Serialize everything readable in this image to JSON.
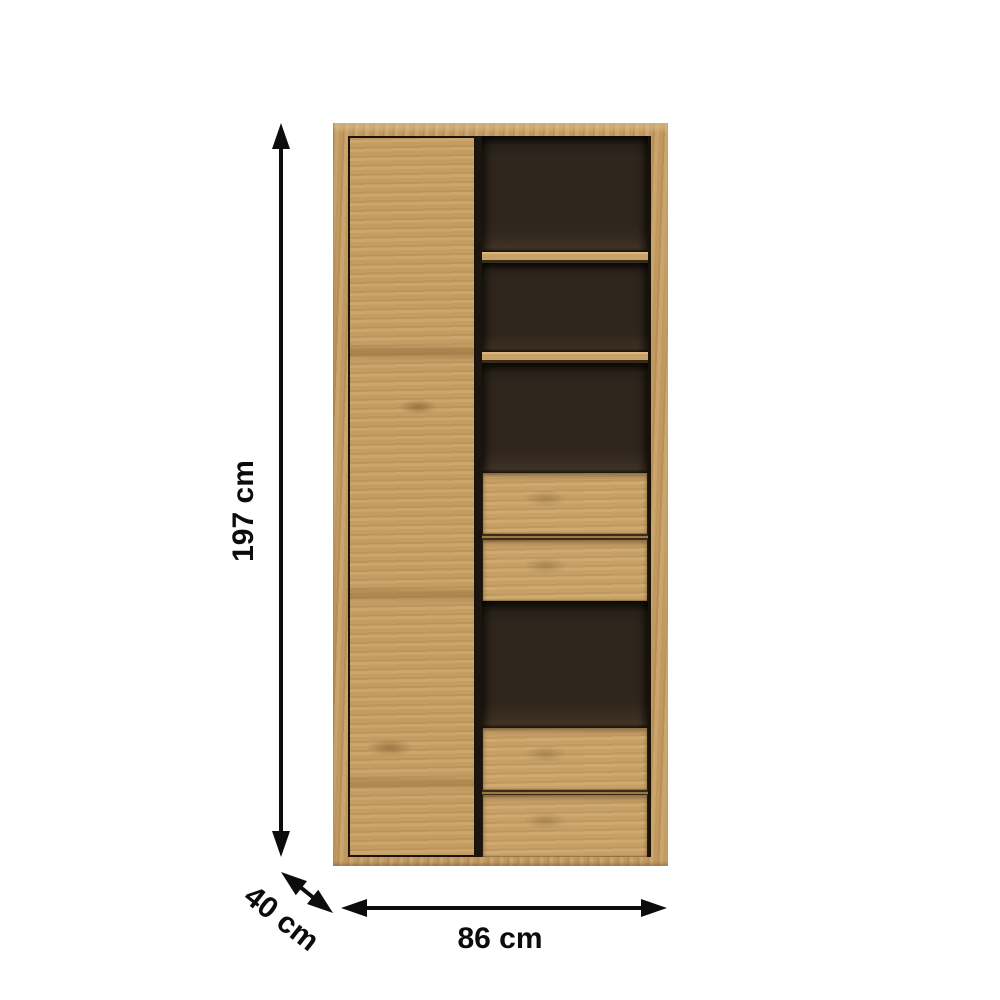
{
  "diagram": {
    "type": "furniture-dimension-diagram",
    "dimensions": {
      "height": "197 cm",
      "depth": "40 cm",
      "width": "86 cm"
    },
    "icons": {
      "height_arrow": "double-headed-vertical-arrow",
      "depth_arrow": "double-headed-diagonal-arrow",
      "width_arrow": "double-headed-horizontal-arrow"
    },
    "colors": {
      "background": "#ffffff",
      "wood": "#c59d62",
      "wood_light": "#dcb87e",
      "wood_shadow": "#8a6638",
      "interior_dark": "#2f261d",
      "outline_dark": "#1a130b",
      "arrow": "#0d0c0a"
    }
  }
}
